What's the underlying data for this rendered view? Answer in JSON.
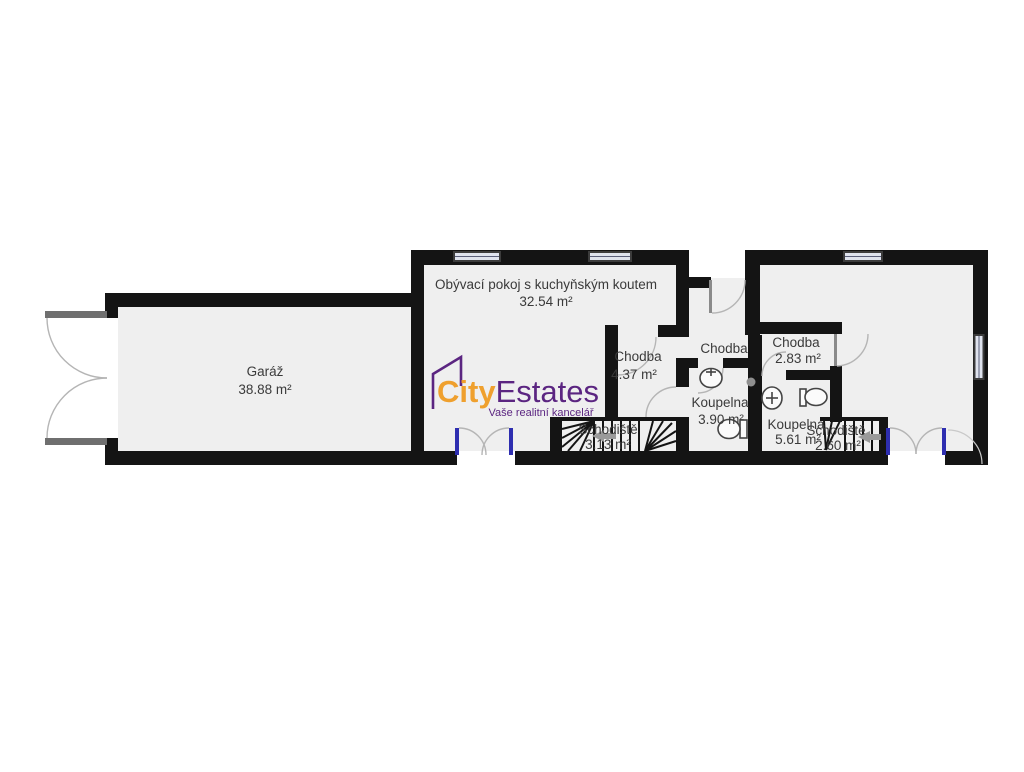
{
  "branding": {
    "logo_text_primary": "City",
    "logo_text_secondary": "Estates",
    "tagline": "Vaše realitní kancelář",
    "color_primary": "#efa02e",
    "color_secondary": "#5b2581"
  },
  "rooms": {
    "garage": {
      "name": "Garáž",
      "area": "38.88 m²"
    },
    "living_room": {
      "name": "Obývací pokoj s kuchyňským koutem",
      "area": "32.54 m²"
    },
    "entry_hall": {
      "name": "Chodba"
    },
    "hallway_left": {
      "name": "Chodba",
      "area": "4.37 m²"
    },
    "hallway_right": {
      "name": "Chodba",
      "area": "2.83 m²"
    },
    "bathroom_center": {
      "name": "Koupelna",
      "area": "3.90 m²"
    },
    "bathroom_right": {
      "name": "Koupelna",
      "area": "5.61 m²"
    },
    "staircase_left": {
      "name": "Schodiště",
      "area": "3.13 m²"
    },
    "staircase_right": {
      "name": "Schodiště",
      "area": "2.60 m²"
    }
  },
  "colors": {
    "wall": "#141414",
    "floor": "#efefef",
    "window_glass": "#dfe3ee",
    "door_jamb": "#2e2eb0",
    "door_arc": "#b5b5b5",
    "stair_arrow": "#9a9a9a",
    "label_text": "#3a3a3a"
  }
}
